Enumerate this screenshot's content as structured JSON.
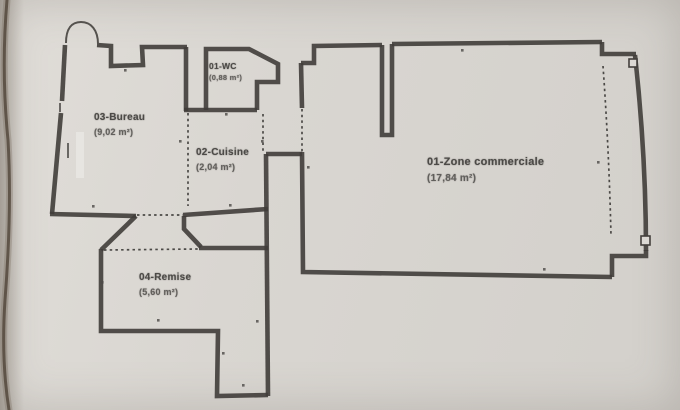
{
  "photo": {
    "type": "scanned floor plan",
    "colors": {
      "paper": "#d8d5d0",
      "wall": "#403d3a",
      "label_text": "#4c4a47"
    },
    "rooms": [
      {
        "name": "03-Bureau",
        "area": "(9,02 m²)"
      },
      {
        "name": "01-WC",
        "area": "(0,88 m²)"
      },
      {
        "name": "02-Cuisine",
        "area": "(2,04 m²)"
      },
      {
        "name": "01-Zone commerciale",
        "area": "(17,84 m²)"
      },
      {
        "name": "04-Remise",
        "area": "(5,60 m²)"
      }
    ]
  }
}
